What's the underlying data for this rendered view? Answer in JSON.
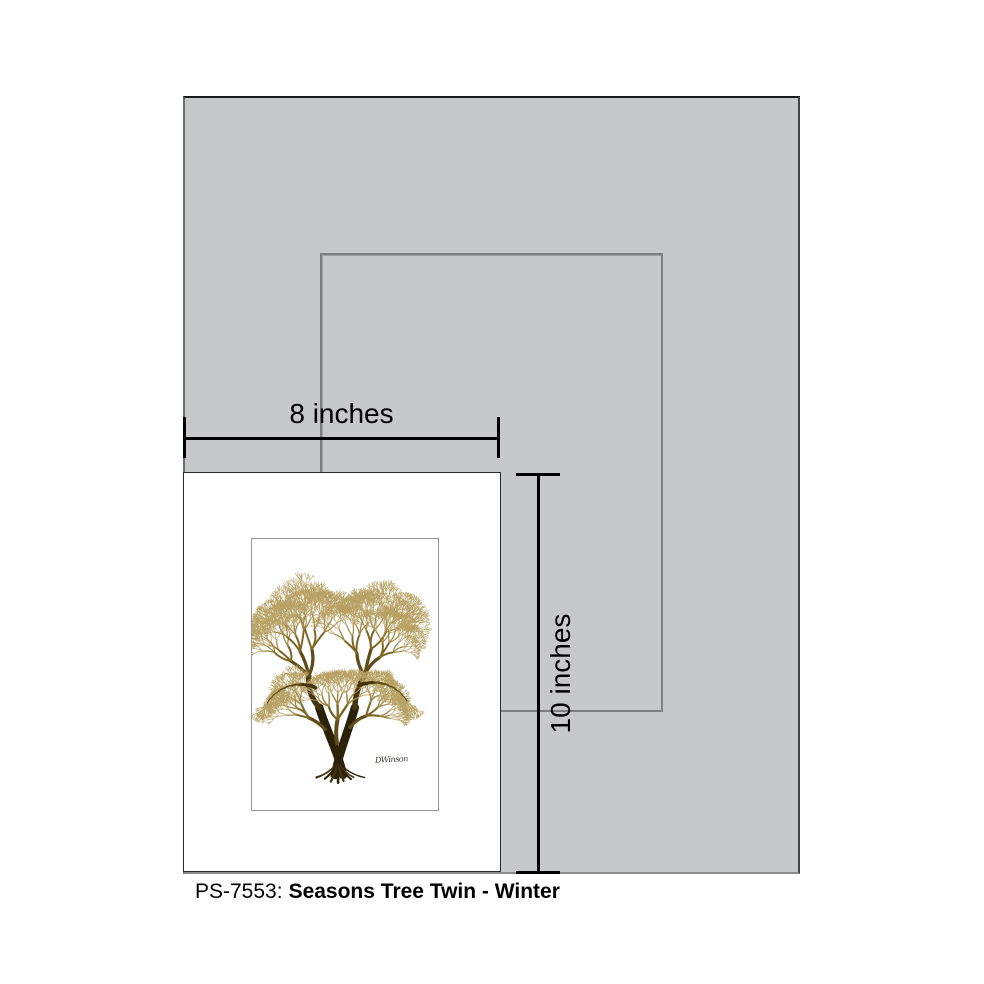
{
  "figure": {
    "caption": {
      "code": "PS-7553:",
      "title": "Seasons Tree Twin - Winter"
    },
    "dimension_labels": {
      "width": "8 inches",
      "height": "10 inches"
    },
    "artwork": {
      "subject": "winter-twin-tree-illustration",
      "signature": "DWinson",
      "palette": [
        "#2a2208",
        "#44350e",
        "#5f4c16",
        "#7d6524",
        "#9c8340",
        "#b7a062"
      ]
    },
    "colors": {
      "backdrop_gray": "#c7c8ca",
      "outline_gray": "#7e7e7e",
      "dimension_black": "#000000",
      "print_white": "#ffffff"
    }
  }
}
